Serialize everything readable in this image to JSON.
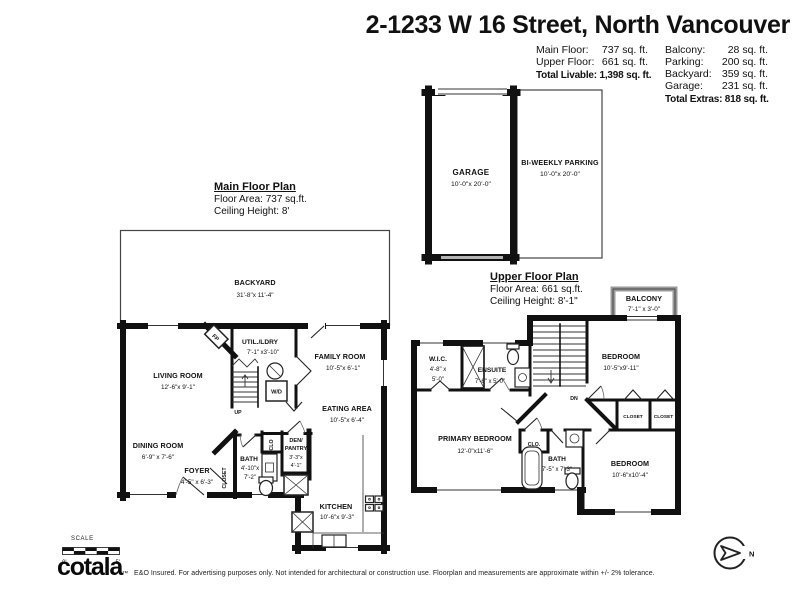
{
  "title": "2-1233 W 16 Street, North Vancouver",
  "stats": {
    "left": [
      {
        "label": "Main Floor:",
        "value": "737 sq. ft."
      },
      {
        "label": "Upper Floor:",
        "value": "661 sq. ft."
      }
    ],
    "left_total": "Total Livable: 1,398 sq. ft.",
    "right": [
      {
        "label": "Balcony:",
        "value": "28 sq. ft."
      },
      {
        "label": "Parking:",
        "value": "200 sq. ft."
      },
      {
        "label": "Backyard:",
        "value": "359 sq. ft."
      },
      {
        "label": "Garage:",
        "value": "231 sq. ft."
      }
    ],
    "right_total": "Total Extras: 818 sq. ft."
  },
  "garage_plan": {
    "garage": {
      "name": "GARAGE",
      "dims": "10'-0\"x 20'-0\""
    },
    "parking": {
      "name": "BI-WEEKLY PARKING",
      "dims": "10'-0\"x 20'-0\""
    }
  },
  "main_floor": {
    "heading": "Main Floor Plan",
    "area": "Floor Area: 737 sq.ft.",
    "ceiling": "Ceiling Height: 8'",
    "backyard": {
      "name": "BACKYARD",
      "dims": "31'-8\"x 11'-4\""
    },
    "living": {
      "name": "LIVING ROOM",
      "dims": "12'-6\"x 9'-1\""
    },
    "util": {
      "name": "UTIL./LDRY",
      "dims": "7'-1\" x3'-10\""
    },
    "family": {
      "name": "FAMILY ROOM",
      "dims": "10'-5\"x 6'-1\""
    },
    "eating": {
      "name": "EATING AREA",
      "dims": "10'-5\"x 6'-4\""
    },
    "dining": {
      "name": "DINING ROOM",
      "dims": "6'-9\" x 7'-6\""
    },
    "foyer": {
      "name": "FOYER",
      "dims": "4'-5\" x 6'-3\""
    },
    "bath": {
      "name": "BATH",
      "dims1": "4'-10\"x",
      "dims2": "7'-2\""
    },
    "den": {
      "l1": "DEN/",
      "l2": "PANTRY",
      "l3": "3'-3\"x",
      "l4": "4'-1\""
    },
    "kitchen": {
      "name": "KITCHEN",
      "dims": "10'-6\"x 9'-3\""
    },
    "fp": "FP",
    "closet": "CLOSET",
    "clo": "CLO",
    "wd": "W/D",
    "up": "UP"
  },
  "upper_floor": {
    "heading": "Upper Floor Plan",
    "area": "Floor Area: 661 sq.ft.",
    "ceiling": "Ceiling Height: 8'-1\"",
    "wic": {
      "name": "W.I.C.",
      "dims1": "4'-8\" x",
      "dims2": "5'-0\""
    },
    "ensuite": {
      "name": "ENSUITE",
      "dims": "7'-6\" x 5'-0\""
    },
    "balcony": {
      "name": "BALCONY",
      "dims": "7'-1\" x 3'-0\""
    },
    "bedroom_tr": {
      "name": "BEDROOM",
      "dims": "10'-5\"x9'-11\""
    },
    "primary": {
      "name": "PRIMARY BEDROOM",
      "dims": "12'-0\"x11'-6\""
    },
    "bath": {
      "name": "BATH",
      "dims": "7'-5\" x 7'-3\""
    },
    "bedroom_br": {
      "name": "BEDROOM",
      "dims": "10'-6\"x10'-4\""
    },
    "closet1": "CLOSET",
    "closet2": "CLOSET",
    "clo": "CLO.",
    "dn": "DN"
  },
  "footer": {
    "scale_label": "SCALE",
    "scale_start": "0'",
    "scale_end": "5'",
    "logo": "cotala",
    "logo_mark": "™",
    "disclaimer": "E&O Insured. For advertising purposes only. Not intended for architectural or construction use. Floorplan and measurements are approximate within +/- 2% tolerance.",
    "north_label": "N"
  }
}
